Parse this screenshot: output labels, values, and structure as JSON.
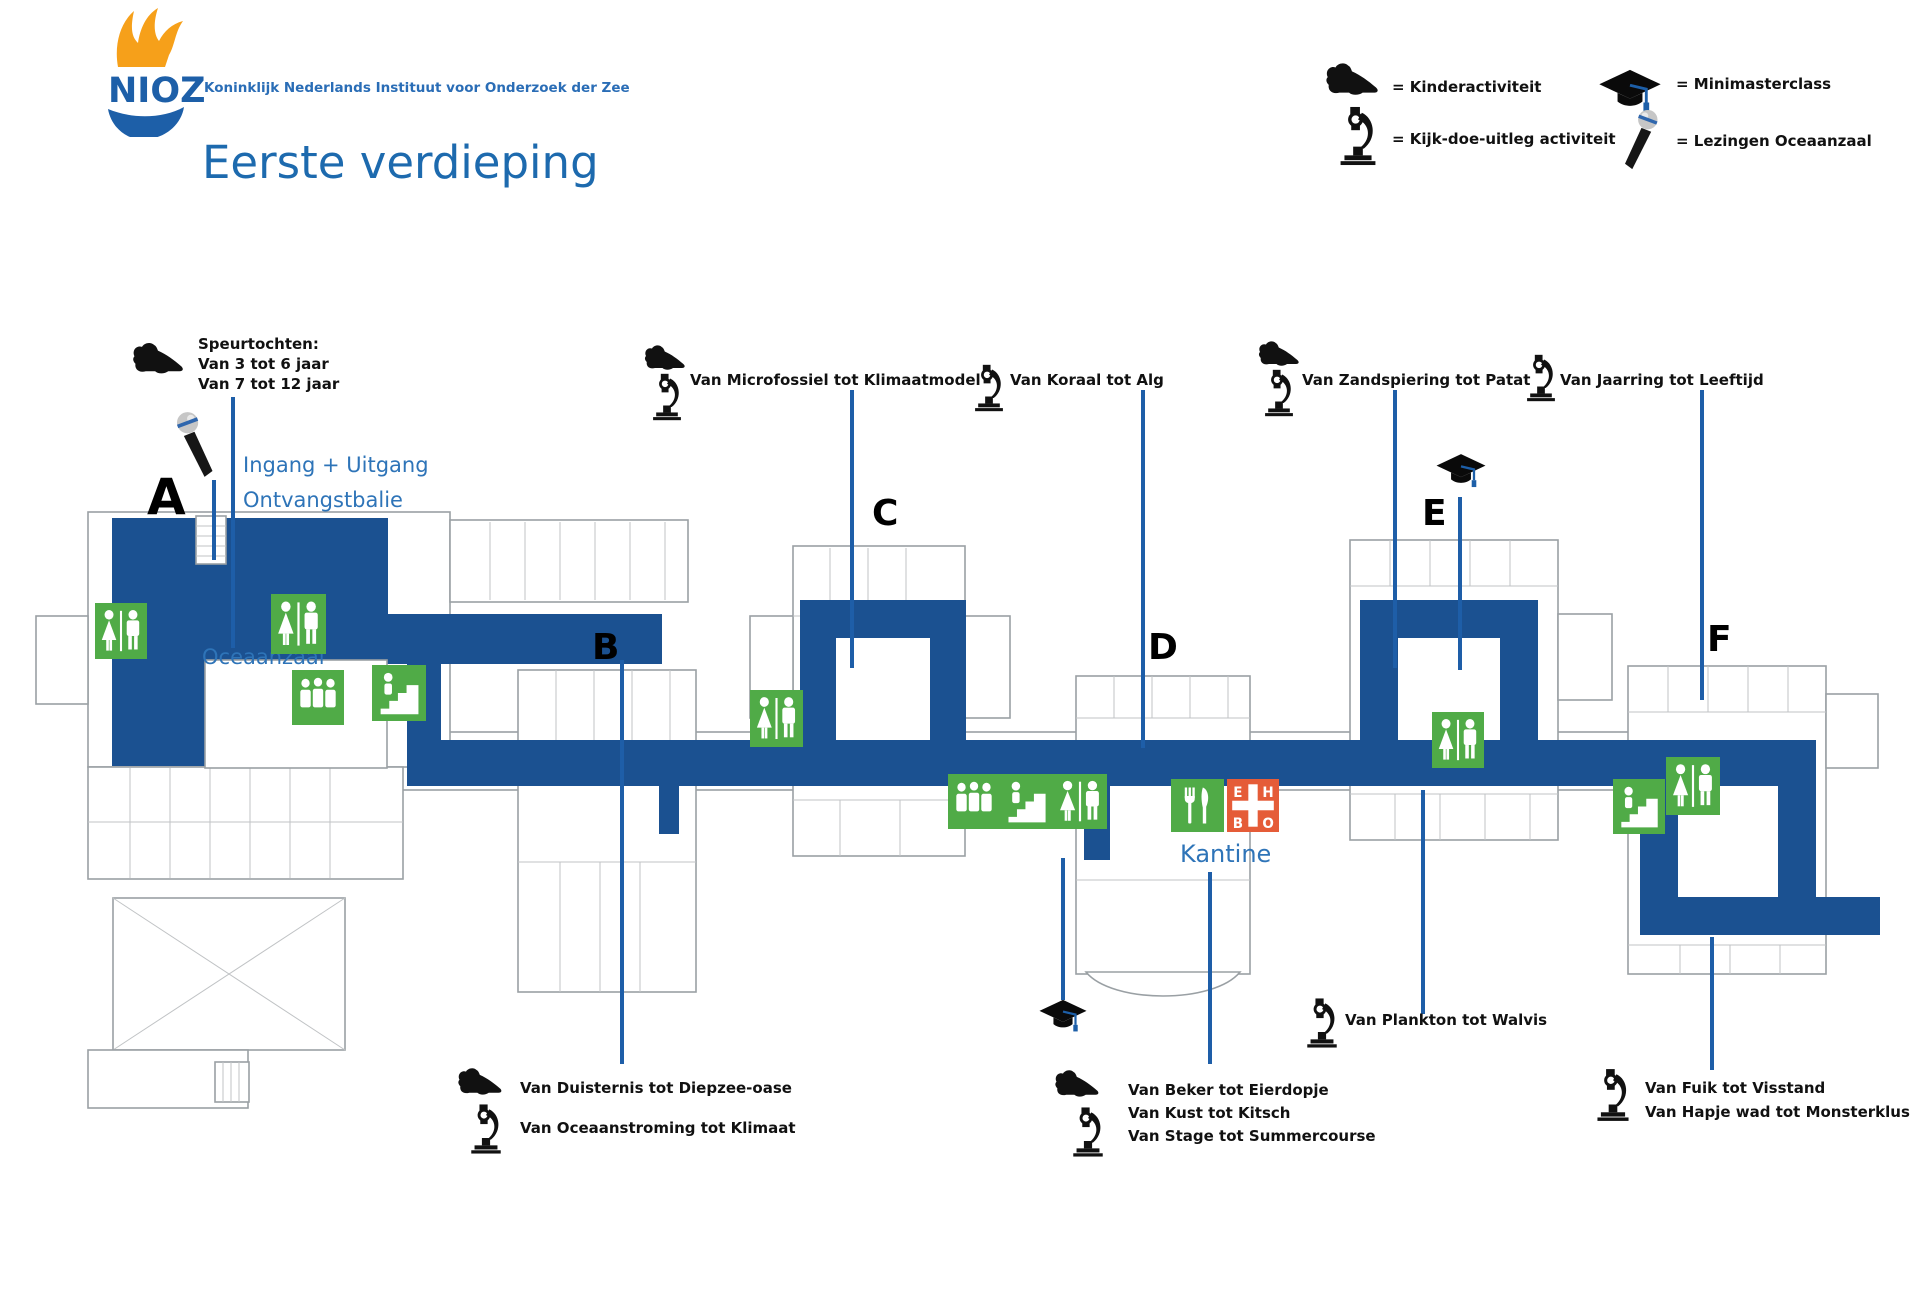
{
  "header": {
    "logo": "NIOZ",
    "org": "Koninklijk Nederlands Instituut voor Onderzoek der Zee",
    "title": "Eerste verdieping"
  },
  "legend": {
    "kinderactiviteit": "= Kinderactiviteit",
    "kijkdoe": "= Kijk-doe-uitleg activiteit",
    "minimasterclass": "= Minimasterclass",
    "lezingen": "= Lezingen Oceaanzaal"
  },
  "buildings": [
    "A",
    "B",
    "C",
    "D",
    "E",
    "F"
  ],
  "rooms": {
    "ingang": "Ingang + Uitgang",
    "ontvangstbalie": "Ontvangstbalie",
    "oceaanzaal": "Oceaanzaal",
    "kantine": "Kantine"
  },
  "speurtochten": [
    "Speurtochten:",
    "Van 3 tot 6 jaar",
    "Van 7 tot 12 jaar"
  ],
  "activities": {
    "microfossiel": "Van Microfossiel tot Klimaatmodel",
    "koraal": "Van Koraal tot Alg",
    "zandspiering": "Van Zandspiering tot Patat",
    "jaarring": "Van Jaarring tot Leeftijd",
    "duisternis": "Van Duisternis tot Diepzee-oase",
    "oceaanstroming": "Van Oceaanstroming tot Klimaat",
    "beker": "Van Beker tot Eierdopje",
    "kust": "Van Kust tot Kitsch",
    "stage": "Van Stage tot Summercourse",
    "plankton": "Van Plankton tot Walvis",
    "fuik": "Van Fuik tot Visstand",
    "hapje": "Van Hapje wad tot Monsterklus"
  },
  "ehbo": "EHBO",
  "colors": {
    "route_blue": "#1b5191",
    "label_blue": "#2e74b8",
    "callout_blue": "#1e5ea8",
    "title_blue": "#1d6aae",
    "org_blue": "#2a6db6",
    "green": "#50ab47",
    "ehbo_red": "#e55c38",
    "logo_orange": "#f6a01a",
    "logo_blue": "#1d5fa8",
    "wall_gray": "#9aa0a4",
    "innerline_gray": "#c0c3c5"
  }
}
